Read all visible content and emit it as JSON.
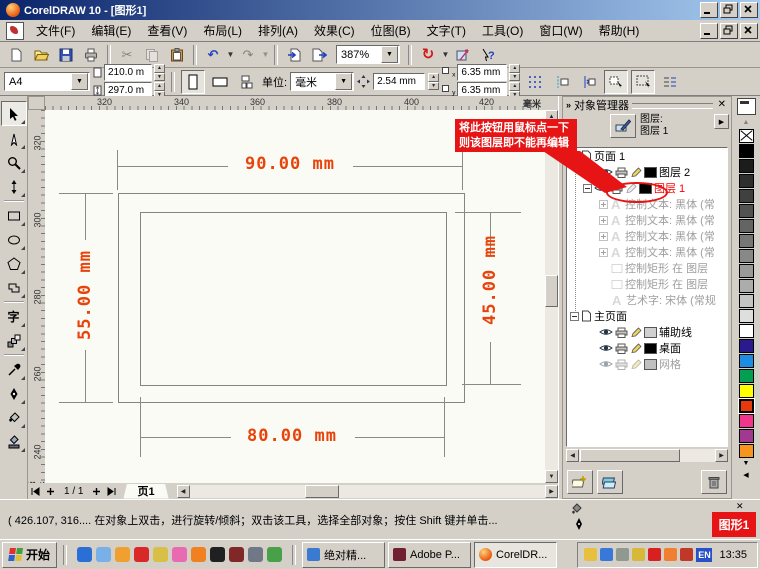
{
  "window": {
    "title": "CorelDRAW 10 - [图形1]"
  },
  "menu": {
    "items": [
      "文件(F)",
      "编辑(E)",
      "查看(V)",
      "布局(L)",
      "排列(A)",
      "效果(C)",
      "位图(B)",
      "文字(T)",
      "工具(O)",
      "窗口(W)",
      "帮助(H)"
    ]
  },
  "standard_toolbar": {
    "zoom_value": "387%"
  },
  "property_bar": {
    "paper_preset": "A4",
    "paper_width": "210.0 m",
    "paper_height": "297.0 m",
    "units_label": "单位:",
    "units_value": "毫米",
    "nudge_value": "2.54 mm",
    "dup_x_label": "x",
    "dup_y_label": "y",
    "dup_x": "6.35 mm",
    "dup_y": "6.35 mm"
  },
  "rulers": {
    "h_ticks": [
      "320",
      "340",
      "360",
      "380",
      "400",
      "420"
    ],
    "h_unit": "毫米",
    "v_ticks": [
      "320",
      "300",
      "280",
      "260",
      "240"
    ],
    "v_unit": "毫米"
  },
  "drawing": {
    "dim_top": "90.00 mm",
    "dim_left": "55.00 mm",
    "dim_right": "45.00 mm",
    "dim_bottom": "80.00 mm",
    "dim_color": "#e8430a"
  },
  "page_nav": {
    "page_info": "1 / 1",
    "page_tab": "页1"
  },
  "callout": {
    "line1": "将此按钮用鼠标点一下",
    "line2": "则该图层即不能再编辑",
    "bg": "#e61414"
  },
  "docker": {
    "title": "对象管理器",
    "layer_caption": "图层:",
    "active_layer": "图层 1",
    "tree": [
      {
        "label": "页面 1"
      },
      {
        "label": "图层 2"
      },
      {
        "label": "图层 1"
      },
      {
        "label": "控制文本: 黑体 (常"
      },
      {
        "label": "控制文本: 黑体 (常"
      },
      {
        "label": "控制文本: 黑体 (常"
      },
      {
        "label": "控制文本: 黑体 (常"
      },
      {
        "label": "控制矩形 在 图层"
      },
      {
        "label": "控制矩形 在 图层"
      },
      {
        "label": "艺术字: 宋体 (常规"
      },
      {
        "label": "主页面"
      },
      {
        "label": "辅助线"
      },
      {
        "label": "桌面"
      },
      {
        "label": "网格"
      }
    ]
  },
  "palette": {
    "swatches": [
      "none",
      "#000000",
      "#1c1c1c",
      "#2e2e2e",
      "#404040",
      "#525252",
      "#646464",
      "#767676",
      "#888888",
      "#9a9a9a",
      "#acacac",
      "#c4c4c4",
      "#dedede",
      "#ffffff",
      "#2b1a8c",
      "#1e8ce0",
      "#00a050",
      "#ffff00",
      "#e8380c",
      "#f0368c",
      "#a03a90",
      "#f7941d"
    ],
    "selected_index": 18
  },
  "status_bar": {
    "text": "( 426.107, 316....  在对象上双击，进行旋转/倾斜；双击该工具，选择全部对象；按住 Shift 键并单击...",
    "doc_badge": "图形1"
  },
  "taskbar": {
    "start_label": "开始",
    "tasks": [
      "绝对精...",
      "Adobe P...",
      "CorelDR..."
    ],
    "lang_indicator": "EN",
    "clock": "13:35"
  }
}
